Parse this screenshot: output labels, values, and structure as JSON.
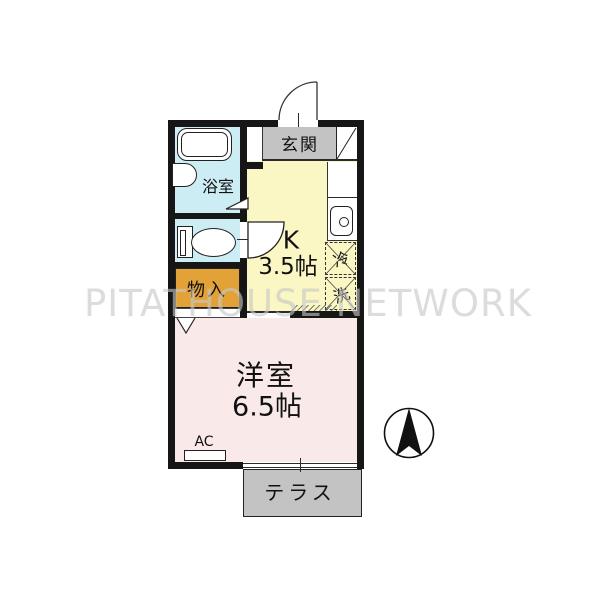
{
  "watermark": "PITATHOUSE NETWORK",
  "rooms": {
    "entrance": {
      "label": "玄関"
    },
    "bathroom": {
      "label": "浴室"
    },
    "storage": {
      "label": "物入"
    },
    "kitchen": {
      "label": "K",
      "size": "3.5帖"
    },
    "fridge": {
      "label": "冷"
    },
    "washer": {
      "label": "洗"
    },
    "main_room": {
      "label": "洋室",
      "size": "6.5帖"
    },
    "ac": {
      "label": "AC"
    },
    "terrace": {
      "label": "テラス"
    }
  },
  "icons": [
    "bathtub-icon",
    "washbasin-icon",
    "toilet-icon",
    "kitchen-sink-icon",
    "entrance-door-arc-icon",
    "kitchen-door-arc-icon",
    "closet-door-icon",
    "bathroom-door-icon",
    "shoe-cabinet-icon",
    "north-compass-icon"
  ],
  "colors": {
    "wall": "#161616",
    "bathroom_bg": "#cdedf4",
    "kitchen_bg": "#faf7c4",
    "storage_bg": "#e2a237",
    "main_room_bg": "#f9e9e8",
    "entrance_bg": "#c3c3c3",
    "terrace_bg": "#c3c3c3",
    "watermark_text": "#c6c6c6"
  }
}
